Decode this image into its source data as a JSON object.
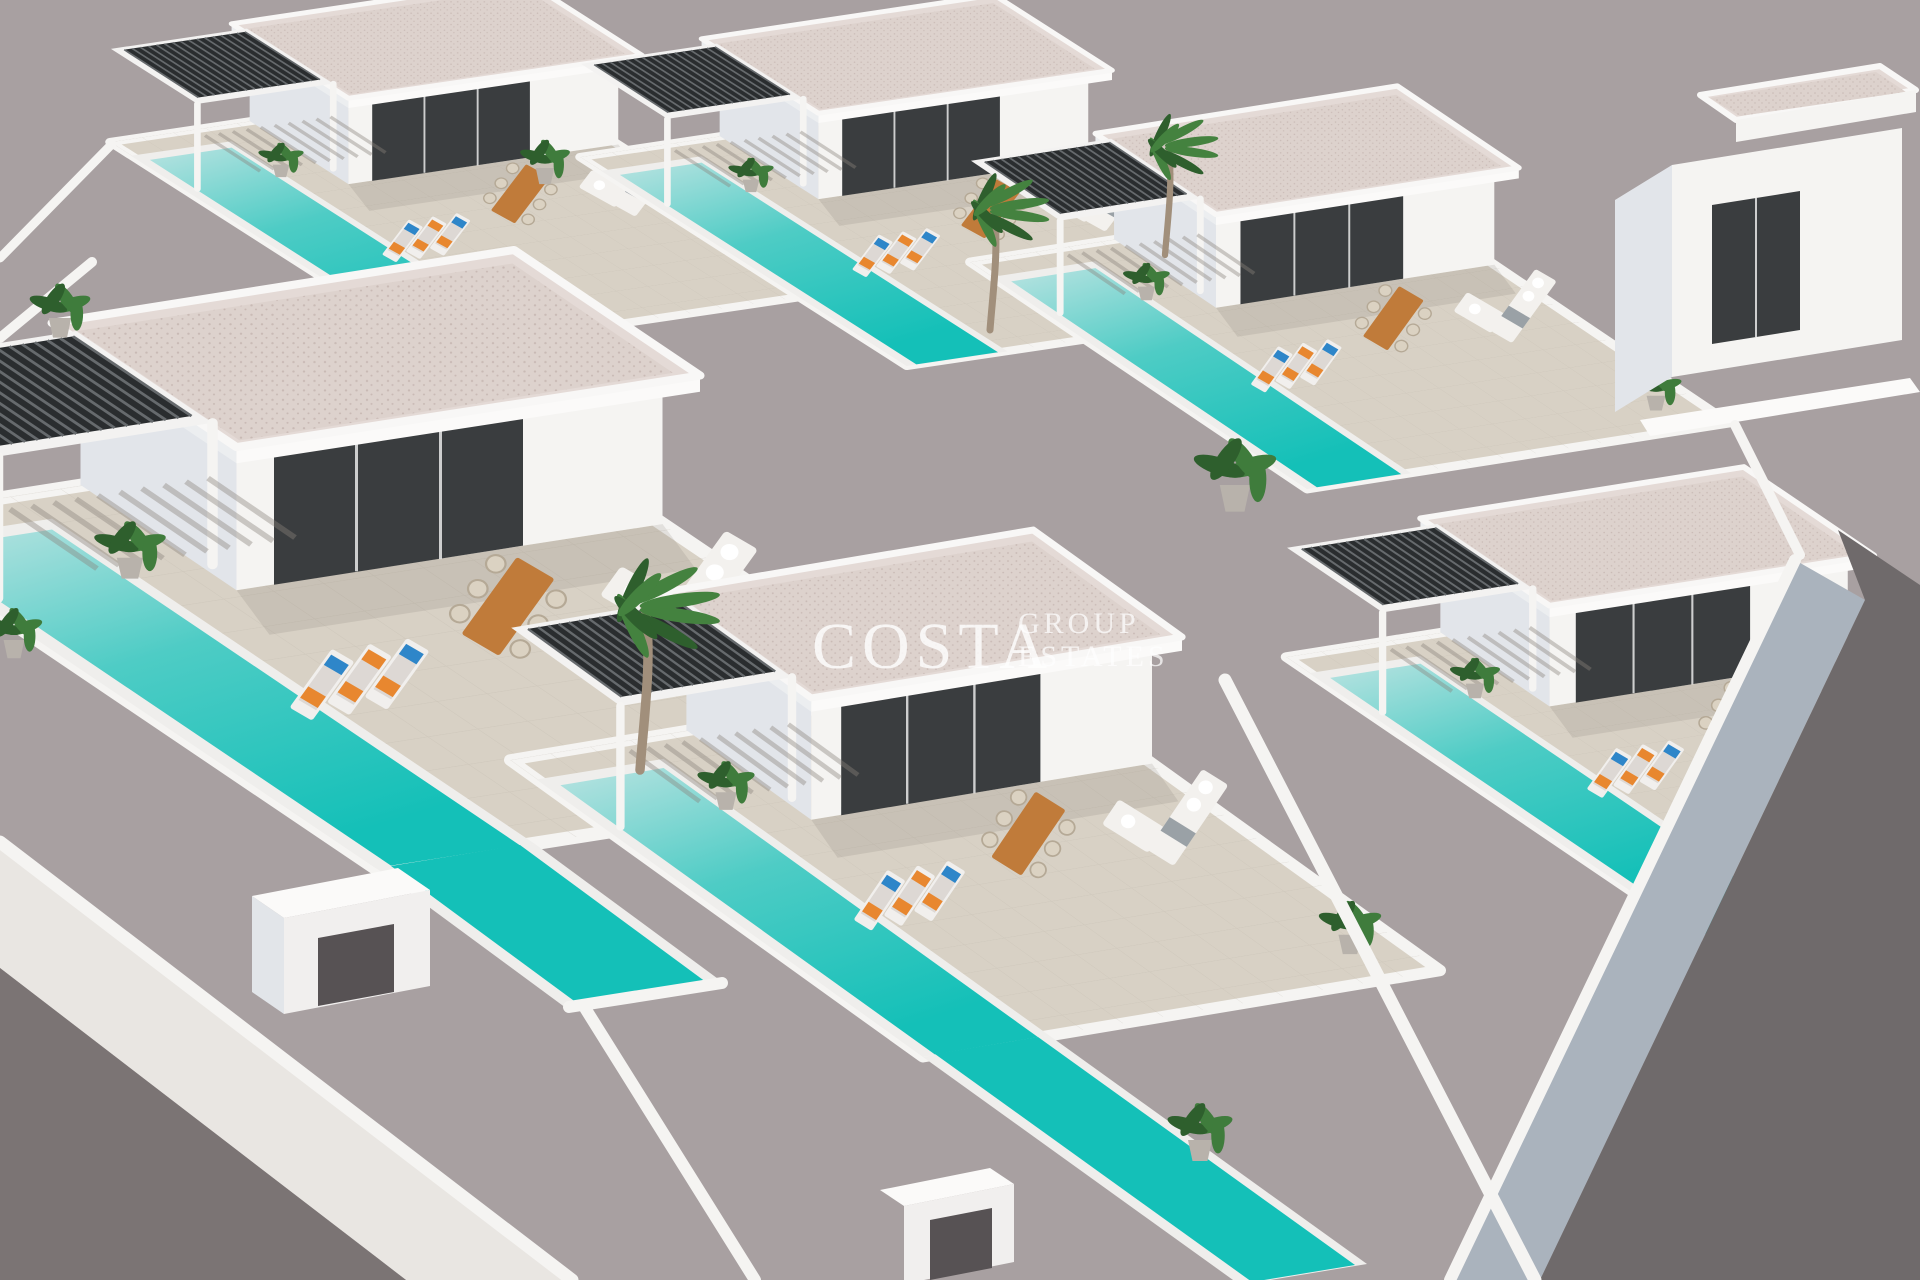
{
  "scene": {
    "type": "3D architectural render, aerial axonometric view",
    "subject": "Modern white villa development with private pools",
    "villas_visible": 7,
    "features": [
      "flat white roofs",
      "long turquoise private pools",
      "dark slatted pergolas",
      "sun loungers with orange and blue cushions",
      "wooden outdoor dining sets",
      "white corner sofas",
      "palm trees and potted plants",
      "perimeter streets with white sidewalks"
    ]
  },
  "watermark": {
    "brand": "COSTA",
    "sub_line1": "GROUP",
    "sub_line2": "ESTATES"
  },
  "colors": {
    "background": "#a8a0a1",
    "wall_white": "#f5f4f2",
    "wall_shadow": "#e2e5ea",
    "glazing_dark": "#3a3d3f",
    "roof_texture": "#ddd2cd",
    "roof_dot": "#c9bab5",
    "terrace": "#d8d1c5",
    "pool_start": "#b9e3e1",
    "pool_mid": "#4eccc5",
    "pool_end": "#14c0b8",
    "pergola_dark": "#2a2d2f",
    "street_dark": "#7b7474",
    "street_dark_right": "#6f6a6b",
    "sidewalk": "#e9e6e2",
    "sidewalk_right": "#aab3bd",
    "plant_green": "#3f7c3c",
    "plant_dark": "#2e5f2d",
    "palm_green": "#44823f",
    "trunk": "#a18f7b",
    "wood": "#c07b3a",
    "cushion_orange": "#e8872f",
    "cushion_blue": "#2e86c9",
    "sofa_white": "#f3f1ee",
    "shadow": "#5a5248"
  }
}
